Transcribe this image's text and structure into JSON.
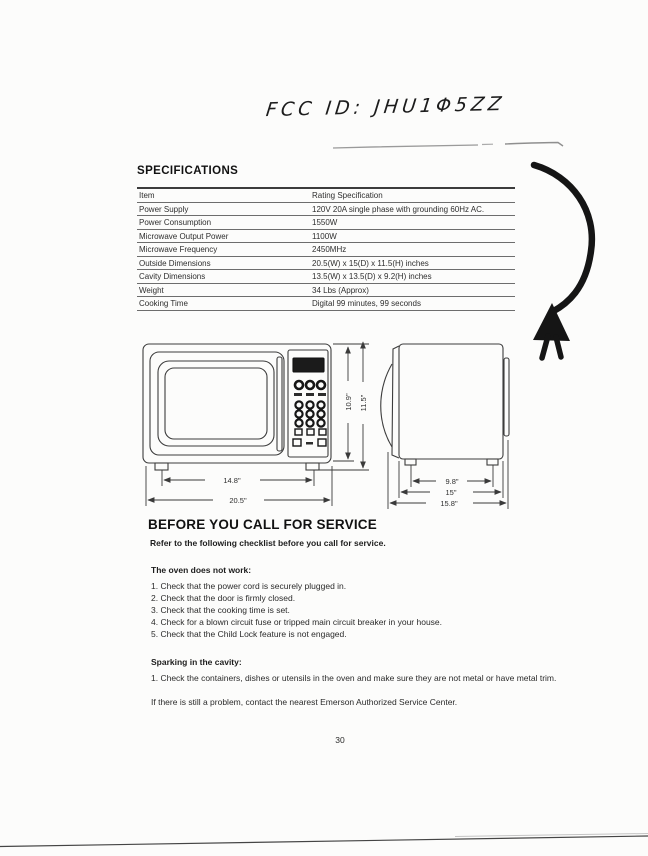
{
  "handwriting": {
    "fcc_id": "FCC ID: JHU1Φ5ZZ"
  },
  "specifications": {
    "title": "SPECIFICATIONS",
    "table": {
      "header": {
        "item": "Item",
        "value": "Rating Specification"
      },
      "rows": [
        {
          "item": "Power Supply",
          "value": "120V 20A single phase with grounding 60Hz AC."
        },
        {
          "item": "Power Consumption",
          "value": "1550W"
        },
        {
          "item": "Microwave Output Power",
          "value": "1100W"
        },
        {
          "item": "Microwave Frequency",
          "value": "2450MHz"
        },
        {
          "item": "Outside Dimensions",
          "value": "20.5(W) x 15(D) x 11.5(H) inches"
        },
        {
          "item": "Cavity Dimensions",
          "value": "13.5(W) x 13.5(D) x 9.2(H) inches"
        },
        {
          "item": "Weight",
          "value": "34 Lbs (Approx)"
        },
        {
          "item": "Cooking Time",
          "value": "Digital 99 minutes, 99 seconds"
        }
      ]
    }
  },
  "diagram": {
    "front": {
      "width_feet": "14.8\"",
      "width_overall": "20.5\"",
      "height_body": "10.9\"",
      "height_overall": "11.5\""
    },
    "side": {
      "depth_feet": "9.8\"",
      "depth_body": "15\"",
      "depth_overall": "15.8\""
    }
  },
  "service": {
    "title": "BEFORE YOU CALL FOR SERVICE",
    "intro": "Refer to the following checklist before you call for service.",
    "sections": [
      {
        "heading": "The oven does not work:",
        "items": [
          "1. Check that the power cord is securely plugged in.",
          "2. Check that the door is firmly closed.",
          "3. Check that the cooking time is set.",
          "4. Check for a blown circuit fuse or tripped main circuit breaker in your house.",
          "5. Check that the Child Lock feature is not engaged."
        ]
      },
      {
        "heading": "Sparking in the cavity:",
        "items": [
          "1. Check the containers, dishes or utensils in the oven and make sure they are not metal or have metal trim."
        ]
      }
    ],
    "footer": "If there is still a problem, contact the nearest Emerson Authorized Service Center."
  },
  "page_number": "30"
}
